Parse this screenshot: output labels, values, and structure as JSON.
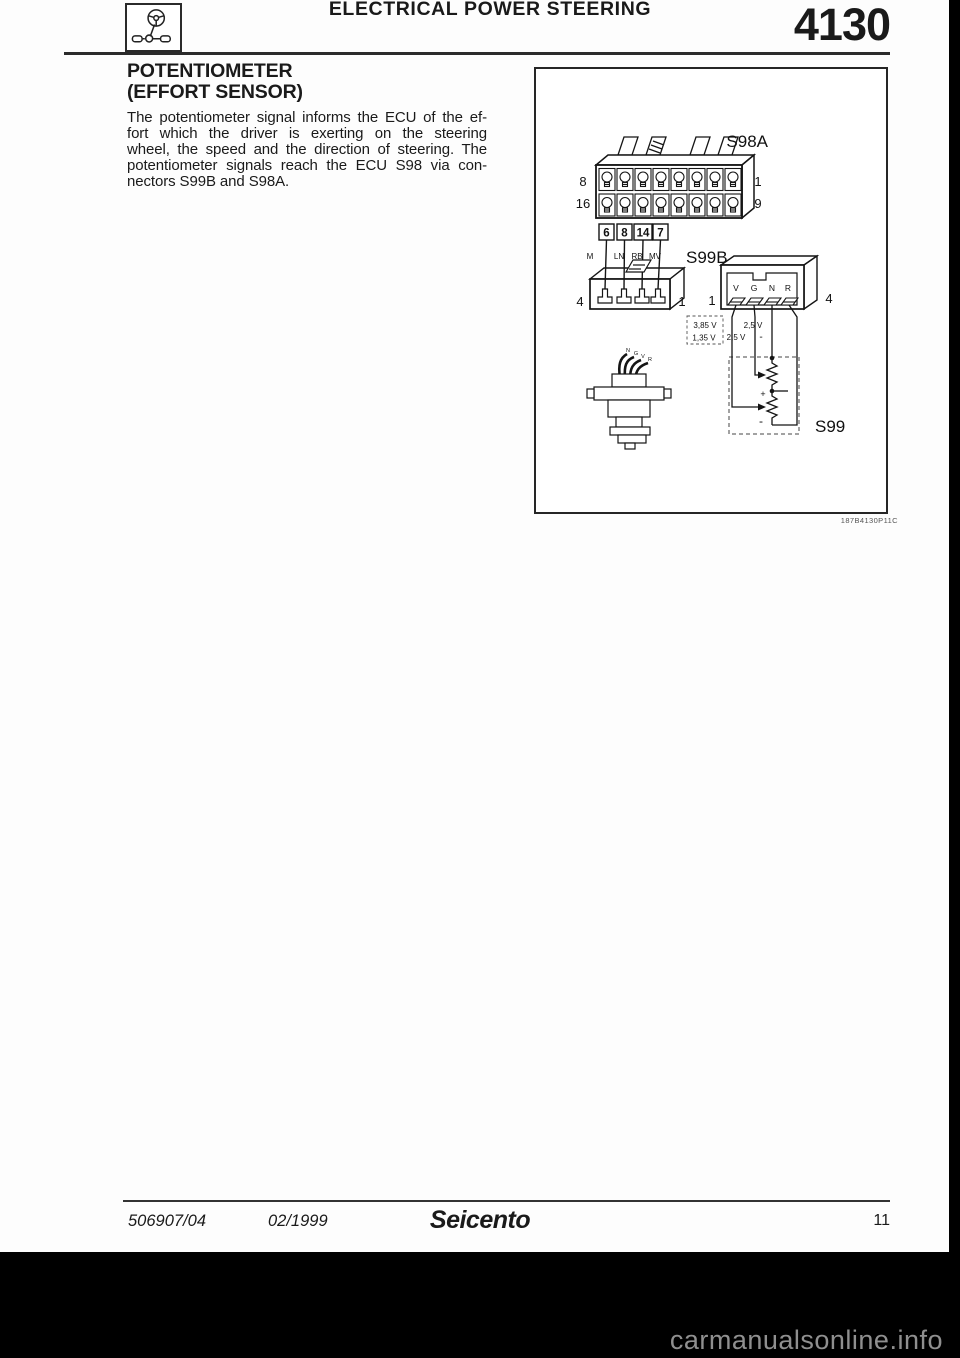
{
  "header": {
    "title": "ELECTRICAL POWER STEERING",
    "section_number": "4130"
  },
  "article": {
    "heading_line1": "POTENTIOMETER",
    "heading_line2": "(EFFORT SENSOR)",
    "paragraph_lines": [
      "The potentiometer signal informs the ECU of the ef-",
      "fort which the driver is exerting on the steering",
      "wheel, the speed and the direction of steering. The",
      "potentiometer signals reach the ECU S98 via con-",
      "nectors S99B and S98A."
    ]
  },
  "diagram": {
    "s98a": {
      "label": "S98A",
      "pin_top_left": "8",
      "pin_bottom_left": "16",
      "pin_top_right": "1",
      "pin_bottom_right": "9",
      "pin_boxes": [
        "6",
        "8",
        "14",
        "7"
      ]
    },
    "wires": {
      "labels": [
        "M",
        "LN",
        "RB",
        "MV"
      ]
    },
    "s99b": {
      "label": "S99B",
      "pin_left": "4",
      "pin_right": "1"
    },
    "mating": {
      "pin_left": "1",
      "pin_right": "4",
      "terminals": [
        "V",
        "G",
        "N",
        "R"
      ]
    },
    "voltages": {
      "v1": "3,85 V",
      "v2": "1,35 V",
      "v3": "2,5 V",
      "v4": "2,5 V",
      "minus": "-"
    },
    "s99": {
      "label": "S99",
      "plus": "+",
      "minus": "-"
    },
    "sensor_wires": [
      "N",
      "G",
      "V",
      "R"
    ],
    "ref_code": "187B4130P11C"
  },
  "footer": {
    "doc_number": "506907/04",
    "date": "02/1999",
    "model": "Seicento",
    "page_number": "11"
  },
  "watermark": "carmanualsonline.info",
  "colors": {
    "text": "#1a1a1a",
    "line": "#222222",
    "watermark": "#8f8f8f",
    "bar": "#000000"
  }
}
